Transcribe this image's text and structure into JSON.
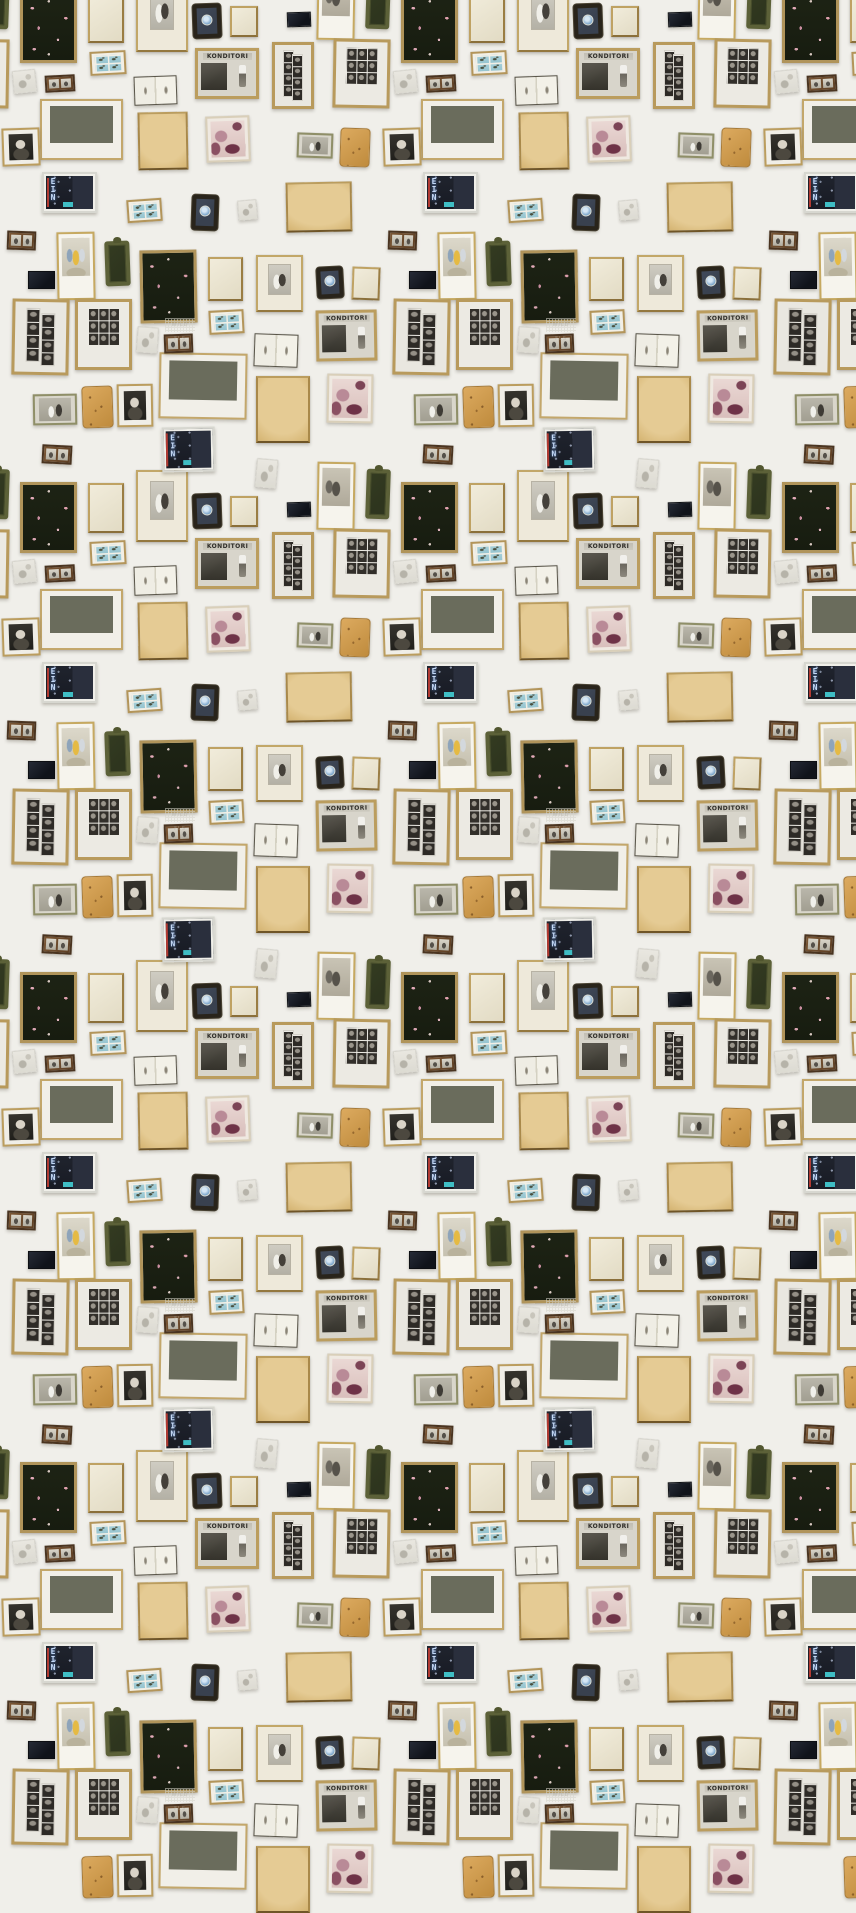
{
  "pattern": {
    "canvas": {
      "width": 856,
      "height": 1856
    },
    "period": {
      "x": 381,
      "y": 490
    },
    "background_color": "#f0efea",
    "palette": {
      "gold_frame": "#b5975a",
      "dark_floral_fabric": "#1b2115",
      "floral_pink": "#e0a9b4",
      "navy_black": "#171a21",
      "olive_green": "#5c6138",
      "tan_paper": "#ddbe83",
      "notebook_leather": "#d09c52",
      "stamp_blue": "#a7d1db",
      "badge_blue": "#8fb4d8",
      "maroon_duotone": "#6e3247",
      "neon_teal": "#3fbdc4",
      "photo_gray": "#d6d4cb",
      "mat_white": "#f2f0e9"
    },
    "labels": {
      "konditori": "KONDITORI",
      "ein-neon": "EIN",
      "faint-note": "WILD FLS"
    },
    "frames": [
      {
        "x": 20,
        "y": 482,
        "w": 57,
        "h": 71,
        "type": "dark-floral",
        "r": 0
      },
      {
        "x": 140,
        "y": 250,
        "w": 57,
        "h": 73,
        "type": "dark-floral",
        "r": -1
      },
      {
        "x": 88,
        "y": 483,
        "w": 36,
        "h": 50,
        "type": "cream-blank",
        "r": 0
      },
      {
        "x": 230,
        "y": 6,
        "w": 28,
        "h": 31,
        "type": "cream-blank",
        "r": 0
      },
      {
        "x": 352,
        "y": 267,
        "w": 28,
        "h": 33,
        "type": "cream-blank",
        "r": 2
      },
      {
        "x": 208,
        "y": 257,
        "w": 35,
        "h": 44,
        "type": "cream-blank",
        "r": 0
      },
      {
        "x": 136,
        "y": 470,
        "w": 52,
        "h": 72,
        "type": "wedding",
        "r": 0
      },
      {
        "x": 256,
        "y": 255,
        "w": 47,
        "h": 57,
        "type": "wedding",
        "r": 0
      },
      {
        "x": 193,
        "y": 4,
        "w": 28,
        "h": 34,
        "type": "badge-ornate",
        "r": -2
      },
      {
        "x": 192,
        "y": 195,
        "w": 26,
        "h": 35,
        "type": "badge-ornate",
        "r": 2
      },
      {
        "x": 317,
        "y": 267,
        "w": 26,
        "h": 31,
        "type": "badge-ornate",
        "r": -3
      },
      {
        "x": 287,
        "y": 12,
        "w": 24,
        "h": 15,
        "type": "navy-rect",
        "r": -2
      },
      {
        "x": 28,
        "y": 271,
        "w": 27,
        "h": 18,
        "type": "navy-rect",
        "r": 0
      },
      {
        "x": 317,
        "y": 462,
        "w": 38,
        "h": 68,
        "type": "polaroid-bw",
        "r": 1
      },
      {
        "x": 57,
        "y": 232,
        "w": 38,
        "h": 68,
        "type": "polaroid-color",
        "r": -1
      },
      {
        "x": 272,
        "y": 42,
        "w": 42,
        "h": 67,
        "type": "photo-strips",
        "r": 0
      },
      {
        "x": 12,
        "y": 299,
        "w": 57,
        "h": 76,
        "type": "photo-strips",
        "r": 1
      },
      {
        "x": 333,
        "y": 39,
        "w": 57,
        "h": 69,
        "type": "photo-grid",
        "r": 1
      },
      {
        "x": 75,
        "y": 299,
        "w": 57,
        "h": 71,
        "type": "photo-grid",
        "r": 0
      },
      {
        "x": 195,
        "y": 48,
        "w": 64,
        "h": 51,
        "type": "konditori",
        "r": 0
      },
      {
        "x": 316,
        "y": 310,
        "w": 61,
        "h": 51,
        "type": "konditori",
        "r": -1
      },
      {
        "x": 90,
        "y": 51,
        "w": 36,
        "h": 24,
        "type": "stamps",
        "r": -3
      },
      {
        "x": 127,
        "y": 199,
        "w": 35,
        "h": 23,
        "type": "stamps",
        "r": -4
      },
      {
        "x": 209,
        "y": 310,
        "w": 35,
        "h": 24,
        "type": "stamps",
        "r": -3
      },
      {
        "x": 134,
        "y": 76,
        "w": 43,
        "h": 29,
        "type": "open-book",
        "r": -2
      },
      {
        "x": 254,
        "y": 334,
        "w": 44,
        "h": 33,
        "type": "open-book",
        "r": 2
      },
      {
        "x": 40,
        "y": 99,
        "w": 83,
        "h": 61,
        "type": "city-photo",
        "r": 0
      },
      {
        "x": 159,
        "y": 353,
        "w": 88,
        "h": 66,
        "type": "city-photo",
        "r": 1
      },
      {
        "x": 138,
        "y": 112,
        "w": 50,
        "h": 58,
        "type": "tan-book",
        "r": -1
      },
      {
        "x": 286,
        "y": 182,
        "w": 66,
        "h": 50,
        "type": "big-tan",
        "r": -1
      },
      {
        "x": 256,
        "y": 376,
        "w": 54,
        "h": 67,
        "type": "big-tan",
        "r": 0
      },
      {
        "x": 206,
        "y": 116,
        "w": 44,
        "h": 46,
        "type": "pink-photo",
        "r": -2
      },
      {
        "x": 327,
        "y": 374,
        "w": 46,
        "h": 49,
        "type": "pink-photo",
        "r": 1
      },
      {
        "x": 297,
        "y": 133,
        "w": 36,
        "h": 25,
        "type": "couple-photo",
        "r": 2
      },
      {
        "x": 33,
        "y": 394,
        "w": 44,
        "h": 31,
        "type": "couple-photo",
        "r": -1
      },
      {
        "x": 340,
        "y": 128,
        "w": 30,
        "h": 39,
        "type": "tan-notebook",
        "r": 2
      },
      {
        "x": 82,
        "y": 386,
        "w": 31,
        "h": 42,
        "type": "tan-notebook",
        "r": -2
      },
      {
        "x": 2,
        "y": 128,
        "w": 38,
        "h": 38,
        "type": "laughing-woman",
        "r": -2
      },
      {
        "x": 117,
        "y": 384,
        "w": 36,
        "h": 43,
        "type": "laughing-woman",
        "r": -1
      },
      {
        "x": 42,
        "y": 172,
        "w": 55,
        "h": 41,
        "type": "ein-neon",
        "r": 0
      },
      {
        "x": 162,
        "y": 427,
        "w": 53,
        "h": 45,
        "type": "ein-neon",
        "r": -1
      },
      {
        "x": 366,
        "y": 469,
        "w": 24,
        "h": 50,
        "type": "olive-ornate",
        "r": 2
      },
      {
        "x": 105,
        "y": 241,
        "w": 25,
        "h": 45,
        "type": "olive-ornate",
        "r": -2
      },
      {
        "x": 45,
        "y": 75,
        "w": 30,
        "h": 17,
        "type": "brown-duo",
        "r": -3
      },
      {
        "x": 7,
        "y": 231,
        "w": 29,
        "h": 19,
        "type": "brown-duo",
        "r": 2
      },
      {
        "x": 164,
        "y": 334,
        "w": 29,
        "h": 19,
        "type": "brown-duo",
        "r": -2
      },
      {
        "x": 42,
        "y": 445,
        "w": 30,
        "h": 19,
        "type": "brown-duo",
        "r": 3
      },
      {
        "x": 13,
        "y": 70,
        "w": 23,
        "h": 23,
        "type": "tiny-faint",
        "r": -6
      },
      {
        "x": 137,
        "y": 327,
        "w": 21,
        "h": 26,
        "type": "tiny-faint",
        "r": 4
      },
      {
        "x": 238,
        "y": 200,
        "w": 19,
        "h": 20,
        "type": "tiny-faint",
        "r": -5
      },
      {
        "x": 256,
        "y": 459,
        "w": 21,
        "h": 29,
        "type": "tiny-faint",
        "r": 5
      },
      {
        "x": 165,
        "y": 318,
        "w": 30,
        "h": 14,
        "type": "faint-note",
        "r": 0
      }
    ]
  }
}
